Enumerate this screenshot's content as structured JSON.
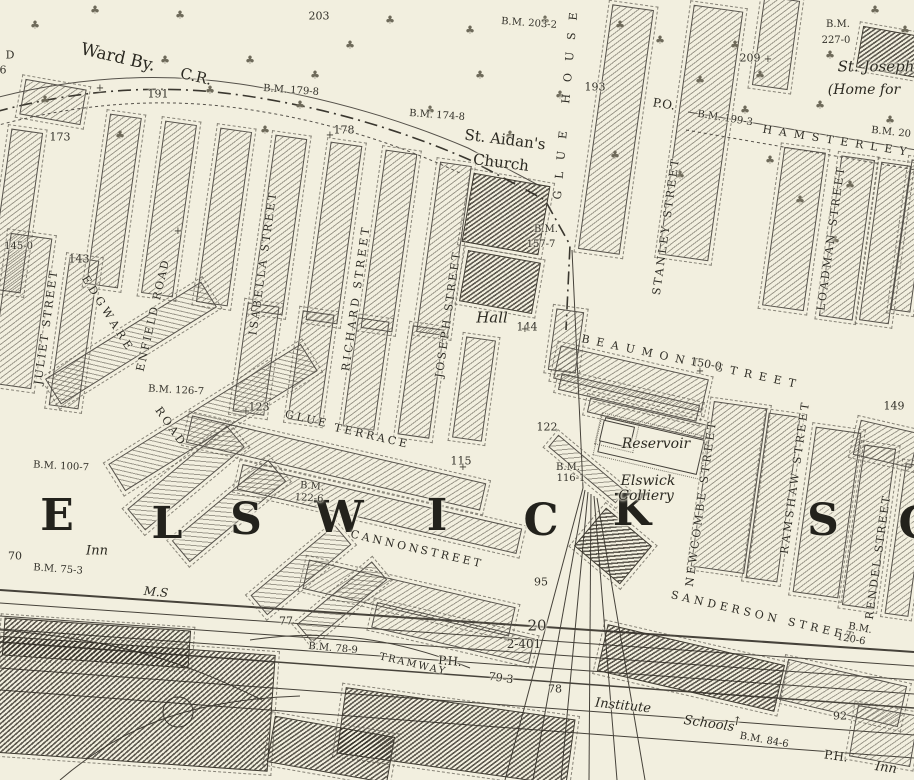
{
  "map": {
    "region_name": "ELSWICK",
    "colors": {
      "paper": "#f2efdf",
      "ink": "#3c382e",
      "text": "#25241e"
    },
    "tree_symbol": "♣",
    "district_letters": [
      {
        "t": "E",
        "x": 57,
        "y": 516
      },
      {
        "t": "L",
        "x": 167,
        "y": 524
      },
      {
        "t": "S",
        "x": 246,
        "y": 520
      },
      {
        "t": "W",
        "x": 339,
        "y": 518
      },
      {
        "t": "I",
        "x": 437,
        "y": 516
      },
      {
        "t": "C",
        "x": 541,
        "y": 521
      },
      {
        "t": "K",
        "x": 632,
        "y": 511
      },
      {
        "t": "S",
        "x": 823,
        "y": 521
      },
      {
        "t": "C",
        "x": 916,
        "y": 524
      }
    ],
    "street_labels": [
      {
        "t": "HAMSTERLEY",
        "x": 838,
        "y": 141,
        "r": 9,
        "ls": 7
      },
      {
        "t": "STANLEY STREET",
        "x": 666,
        "y": 226,
        "r": -82,
        "ls": 2.5
      },
      {
        "t": "LOADMAN STREET",
        "x": 831,
        "y": 238,
        "r": -82,
        "ls": 2.5
      },
      {
        "t": "BEAUMONT STREET",
        "x": 692,
        "y": 362,
        "r": 12,
        "ls": 7
      },
      {
        "t": "NEWCOMBE STREET",
        "x": 701,
        "y": 503,
        "r": -82,
        "ls": 3
      },
      {
        "t": "RAMSHAW STREET",
        "x": 795,
        "y": 477,
        "r": -82,
        "ls": 3
      },
      {
        "t": "RENDEL STREET",
        "x": 878,
        "y": 557,
        "r": -82,
        "ls": 2
      },
      {
        "t": "SANDERSON STREET",
        "x": 764,
        "y": 616,
        "r": 13,
        "ls": 4
      },
      {
        "t": "ISABELLA STREET",
        "x": 263,
        "y": 263,
        "r": -82,
        "ls": 2.5
      },
      {
        "t": "RICHARD STREET",
        "x": 356,
        "y": 298,
        "r": -82,
        "ls": 3
      },
      {
        "t": "JOSEPH STREET",
        "x": 448,
        "y": 314,
        "r": -82,
        "ls": 2.5
      },
      {
        "t": "JULIET STREET",
        "x": 46,
        "y": 327,
        "r": -82,
        "ls": 2
      },
      {
        "t": "EDGWARE",
        "x": 108,
        "y": 314,
        "r": 58,
        "ls": 4
      },
      {
        "t": "ENFIELD ROAD",
        "x": 153,
        "y": 315,
        "r": -77,
        "ls": 2
      },
      {
        "t": "ROAD",
        "x": 171,
        "y": 427,
        "r": 55,
        "ls": 3
      },
      {
        "t": "GLUE",
        "x": 307,
        "y": 419,
        "r": 13,
        "ls": 3
      },
      {
        "t": "TERRACE",
        "x": 372,
        "y": 436,
        "r": 13,
        "ls": 3
      },
      {
        "t": "CANNON",
        "x": 386,
        "y": 542,
        "r": 13,
        "ls": 3
      },
      {
        "t": "STREET",
        "x": 452,
        "y": 557,
        "r": 13,
        "ls": 3
      },
      {
        "t": "GLUE HOUSE",
        "x": 566,
        "y": 100,
        "r": -85,
        "ls": 12
      },
      {
        "t": "TRAMWAY",
        "x": 413,
        "y": 665,
        "r": 13,
        "ls": 2,
        "s": 10
      }
    ],
    "place_labels": [
      {
        "t": "Ward By.",
        "x": 118,
        "y": 58,
        "r": 13,
        "s": 17,
        "st": "bound"
      },
      {
        "t": "C.R.",
        "x": 196,
        "y": 77,
        "r": 13,
        "s": 15,
        "st": "bound"
      },
      {
        "t": "St. Aidan's",
        "x": 505,
        "y": 140,
        "r": 7,
        "s": 15,
        "st": "bound"
      },
      {
        "t": "Church",
        "x": 501,
        "y": 163,
        "r": 7,
        "s": 15,
        "st": "bound"
      },
      {
        "t": "St. Joseph",
        "x": 876,
        "y": 67,
        "s": 15,
        "st": "place"
      },
      {
        "t": "(Home for",
        "x": 864,
        "y": 90,
        "s": 14,
        "st": "place"
      },
      {
        "t": "Hall",
        "x": 492,
        "y": 318,
        "s": 15,
        "st": "place"
      },
      {
        "t": "Reservoir",
        "x": 656,
        "y": 444,
        "s": 14,
        "st": "place"
      },
      {
        "t": "Elswick",
        "x": 648,
        "y": 481,
        "s": 14,
        "st": "place"
      },
      {
        "t": "Colliery",
        "x": 646,
        "y": 496,
        "s": 14,
        "st": "place"
      },
      {
        "t": "Institute",
        "x": 623,
        "y": 706,
        "r": 6,
        "s": 13,
        "st": "place"
      },
      {
        "t": "Schools",
        "x": 709,
        "y": 724,
        "r": 8,
        "s": 13,
        "st": "place"
      },
      {
        "t": "Inn",
        "x": 97,
        "y": 551,
        "s": 13,
        "st": "place"
      },
      {
        "t": "Inn",
        "x": 886,
        "y": 768,
        "r": 8,
        "s": 13,
        "st": "place"
      },
      {
        "t": "M.S",
        "x": 156,
        "y": 592,
        "r": 5,
        "s": 12,
        "st": "place"
      },
      {
        "t": "P.H.",
        "x": 450,
        "y": 661,
        "r": 5,
        "s": 12,
        "st": "bound"
      },
      {
        "t": "P.H.",
        "x": 836,
        "y": 756,
        "r": 8,
        "s": 12,
        "st": "bound"
      },
      {
        "t": "P.O.",
        "x": 664,
        "y": 104,
        "r": 9,
        "s": 12,
        "st": "bound"
      }
    ],
    "benchmark_labels": [
      {
        "t": "B.M. 203-2",
        "x": 529,
        "y": 24,
        "r": 4
      },
      {
        "t": "B.M.",
        "x": 838,
        "y": 25
      },
      {
        "t": "227-0",
        "x": 836,
        "y": 41
      },
      {
        "t": "B.M. 179-8",
        "x": 291,
        "y": 91,
        "r": 4
      },
      {
        "t": "B.M. 174-8",
        "x": 437,
        "y": 116,
        "r": 4
      },
      {
        "t": "B.M. 199-3",
        "x": 725,
        "y": 119,
        "r": 9
      },
      {
        "t": "B.M. 20",
        "x": 891,
        "y": 133,
        "r": 6
      },
      {
        "t": "B.M.",
        "x": 546,
        "y": 230
      },
      {
        "t": "157-7",
        "x": 541,
        "y": 245
      },
      {
        "t": "B.M. 145-0",
        "x": 5,
        "y": 247
      },
      {
        "t": "B.M. 126-7",
        "x": 176,
        "y": 391,
        "r": 3
      },
      {
        "t": "B.M. 100-7",
        "x": 61,
        "y": 467,
        "r": 3
      },
      {
        "t": "B.M. 75-3",
        "x": 58,
        "y": 570,
        "r": 4
      },
      {
        "t": "B.M.",
        "x": 312,
        "y": 487,
        "r": 4
      },
      {
        "t": "122-6",
        "x": 309,
        "y": 499,
        "r": 4
      },
      {
        "t": "B.M.",
        "x": 568,
        "y": 468
      },
      {
        "t": "116-1",
        "x": 571,
        "y": 479
      },
      {
        "t": "B.M. 78-9",
        "x": 333,
        "y": 649,
        "r": 5
      },
      {
        "t": "B.M. 84-6",
        "x": 764,
        "y": 741,
        "r": 10
      },
      {
        "t": "B.M.",
        "x": 860,
        "y": 629,
        "r": 10
      },
      {
        "t": "120-6",
        "x": 851,
        "y": 640,
        "r": 10
      }
    ],
    "number_labels": [
      {
        "t": "203",
        "x": 319,
        "y": 16
      },
      {
        "t": "209",
        "x": 750,
        "y": 58
      },
      {
        "t": "193",
        "x": 595,
        "y": 87
      },
      {
        "t": "191",
        "x": 158,
        "y": 94
      },
      {
        "t": "178",
        "x": 344,
        "y": 130
      },
      {
        "t": "173",
        "x": 60,
        "y": 137
      },
      {
        "t": "143",
        "x": 79,
        "y": 259
      },
      {
        "t": "144",
        "x": 527,
        "y": 327
      },
      {
        "t": "150-0",
        "x": 706,
        "y": 364,
        "r": 10
      },
      {
        "t": "149",
        "x": 894,
        "y": 406
      },
      {
        "t": "123",
        "x": 259,
        "y": 407
      },
      {
        "t": "122",
        "x": 547,
        "y": 427
      },
      {
        "t": "115",
        "x": 461,
        "y": 461
      },
      {
        "t": "95",
        "x": 541,
        "y": 582
      },
      {
        "t": "92",
        "x": 840,
        "y": 716
      },
      {
        "t": "70",
        "x": 15,
        "y": 556
      },
      {
        "t": "77",
        "x": 286,
        "y": 621
      },
      {
        "t": "79-3",
        "x": 501,
        "y": 678,
        "r": 8
      },
      {
        "t": "78",
        "x": 555,
        "y": 689
      },
      {
        "t": "20",
        "x": 537,
        "y": 626,
        "s": 15
      },
      {
        "t": "2-401",
        "x": 524,
        "y": 644,
        "s": 12
      },
      {
        "t": "D",
        "x": 10,
        "y": 55
      },
      {
        "t": "6",
        "x": 3,
        "y": 70
      }
    ],
    "survey_marks": [
      {
        "t": "+",
        "x": 330,
        "y": 136
      },
      {
        "t": "+",
        "x": 246,
        "y": 412
      },
      {
        "t": "+",
        "x": 463,
        "y": 468
      },
      {
        "t": "+",
        "x": 100,
        "y": 89
      },
      {
        "t": "+",
        "x": 768,
        "y": 60
      },
      {
        "t": "+",
        "x": 525,
        "y": 330
      },
      {
        "t": "+",
        "x": 178,
        "y": 232
      },
      {
        "t": "+",
        "x": 700,
        "y": 372
      },
      {
        "t": "↑",
        "x": 737,
        "y": 721,
        "r": 10,
        "s": 12
      }
    ],
    "trees": [
      [
        45,
        100
      ],
      [
        120,
        135
      ],
      [
        210,
        90
      ],
      [
        300,
        105
      ],
      [
        350,
        45
      ],
      [
        430,
        110
      ],
      [
        480,
        75
      ],
      [
        620,
        25
      ],
      [
        560,
        95
      ],
      [
        510,
        135
      ],
      [
        615,
        155
      ],
      [
        660,
        40
      ],
      [
        735,
        45
      ],
      [
        770,
        160
      ],
      [
        820,
        105
      ],
      [
        850,
        185
      ],
      [
        890,
        120
      ],
      [
        35,
        25
      ],
      [
        95,
        10
      ],
      [
        165,
        60
      ],
      [
        250,
        60
      ],
      [
        390,
        20
      ],
      [
        470,
        30
      ],
      [
        545,
        20
      ],
      [
        700,
        80
      ],
      [
        760,
        75
      ],
      [
        830,
        55
      ],
      [
        875,
        10
      ],
      [
        905,
        30
      ],
      [
        315,
        75
      ],
      [
        265,
        130
      ],
      [
        180,
        15
      ],
      [
        680,
        175
      ],
      [
        745,
        110
      ],
      [
        800,
        200
      ],
      [
        835,
        240
      ]
    ]
  }
}
